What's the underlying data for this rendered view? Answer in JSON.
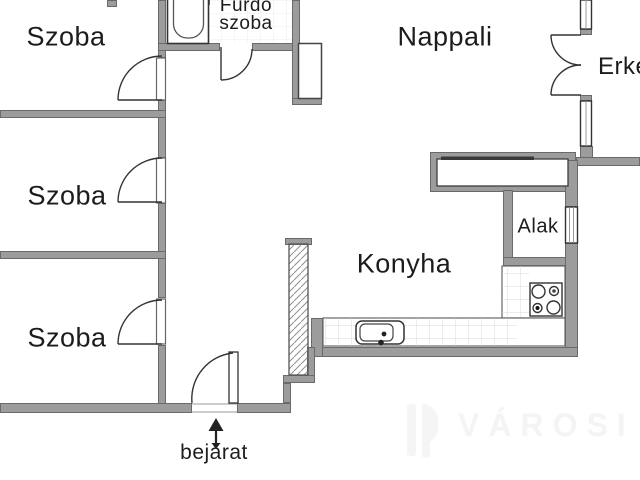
{
  "title": "apartment-floor-plan",
  "labels": {
    "room_top_left": "Szoba",
    "room_mid_left": "Szoba",
    "room_bottom_left": "Szoba",
    "bathroom_line1": "Fürdő",
    "bathroom_line2": "szoba",
    "living_room": "Nappali",
    "balcony": "Erké",
    "niche": "Alak",
    "kitchen": "Konyha",
    "entrance": "bejárat"
  },
  "watermark": {
    "text": "VÁROSI"
  },
  "colors": {
    "wall": "#9c9c9c",
    "line": "#333333",
    "tile": "#dcdcdc",
    "faint_tile": "#ededed",
    "text": "#1c1c1c",
    "background": "#ffffff",
    "watermark": "#f5f5f5"
  }
}
